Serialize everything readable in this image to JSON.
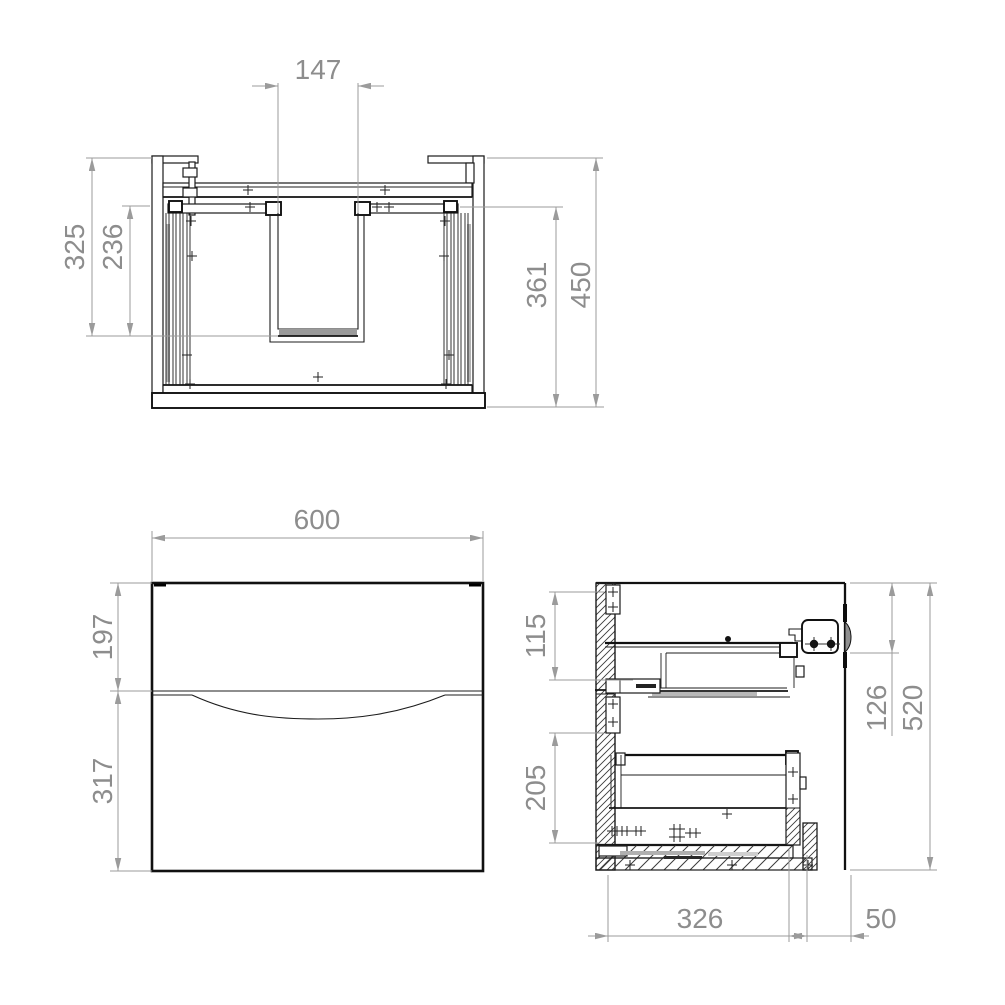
{
  "drawing": {
    "subject": "vanity-unit-technical-drawing-three-views",
    "colors": {
      "ink": "#1c1c1c",
      "dimension": "#8d8d8d",
      "background": "#ffffff"
    },
    "top_view": {
      "cutout_width": "147",
      "depth_to_cutout": "325",
      "drawer_inner_depth": "236",
      "inner_depth": "361",
      "overall_depth": "450"
    },
    "front_view": {
      "width": "600",
      "top_drawer_front_height": "197",
      "bottom_drawer_front_height": "317"
    },
    "side_view": {
      "top_drawer_inner_height": "115",
      "bottom_drawer_inner_height": "205",
      "top_section_height": "126",
      "overall_height": "520",
      "drawer_depth": "326",
      "rear_service_gap": "50"
    }
  }
}
